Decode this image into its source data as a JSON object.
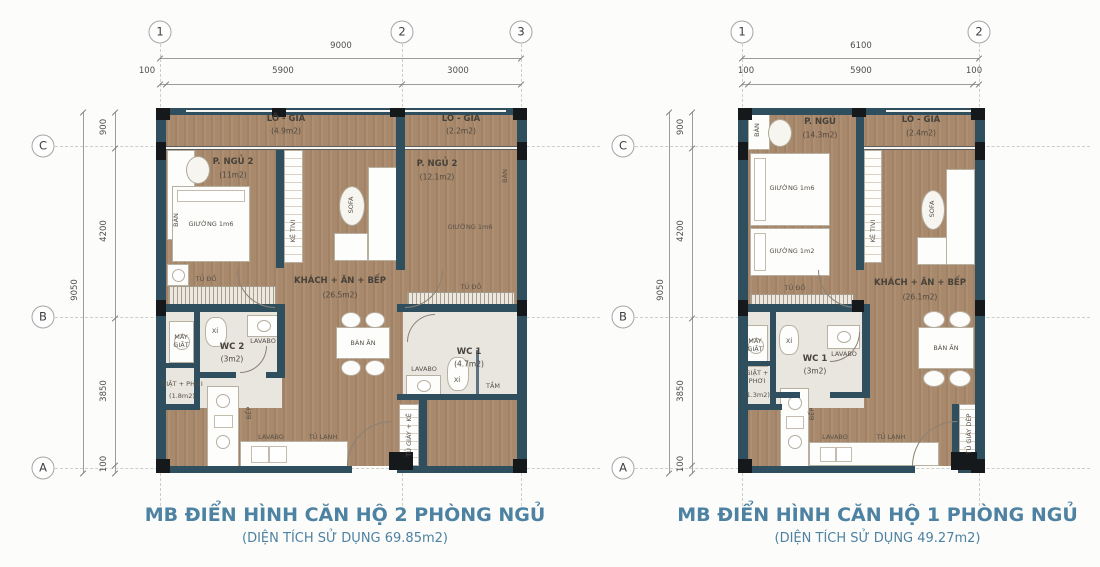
{
  "p2": {
    "title": "MB ĐIỂN HÌNH CĂN HỘ 2 PHÒNG NGỦ",
    "subtitle": "(DIỆN TÍCH SỬ DỤNG 69.85m2)",
    "cols": [
      "1",
      "2",
      "3"
    ],
    "rows": [
      "C",
      "B",
      "A"
    ],
    "dim_top_total": "9000",
    "dim_top": [
      "100",
      "5900",
      "3000"
    ],
    "dim_side_total": "9050",
    "dim_side": [
      "900",
      "4200",
      "3850",
      "100"
    ],
    "rooms": {
      "logia_l": {
        "n": "LÔ - GIA",
        "a": "(4.9m2)"
      },
      "logia_r": {
        "n": "LÔ - GIA",
        "a": "(2.2m2)"
      },
      "bed_l": {
        "n": "P. NGỦ 2",
        "a": "(11m2)"
      },
      "bed_r": {
        "n": "P. NGỦ 2",
        "a": "(12.1m2)"
      },
      "living": {
        "n": "KHÁCH + ĂN + BẾP",
        "a": "(26.5m2)"
      },
      "wc2": {
        "n": "WC 2",
        "a": "(3m2)"
      },
      "wc1": {
        "n": "WC 1",
        "a": "(4.7m2)"
      },
      "laundry": {
        "n": "GIẶT + PHƠI",
        "a": "(1.8m2)"
      }
    },
    "f": {
      "desk": "BÀN",
      "bed16": "GIƯỜNG 1m6",
      "wardrobe": "TỦ ĐỒ",
      "tv": "KỆ TIVI",
      "sofa": "SOFA",
      "dining": "BÀN ĂN",
      "washer": "MÁY GIẶT",
      "xi": "XÍ",
      "lavabo": "LAVABO",
      "bath": "TẮM",
      "stove": "BẾP",
      "fridge": "TỦ LẠNH",
      "shoe": "TỦ GIÀY + KỆ"
    }
  },
  "p1": {
    "title": "MB ĐIỂN HÌNH CĂN HỘ 1 PHÒNG NGỦ",
    "subtitle": "(DIỆN TÍCH SỬ DỤNG 49.27m2)",
    "cols": [
      "1",
      "2"
    ],
    "rows": [
      "C",
      "B",
      "A"
    ],
    "dim_top_total": "6100",
    "dim_top": [
      "100",
      "5900",
      "100"
    ],
    "dim_side_total": "9050",
    "dim_side": [
      "900",
      "4200",
      "3850",
      "100"
    ],
    "rooms": {
      "bedroom": {
        "n": "P. NGỦ",
        "a": "(14.3m2)"
      },
      "logia": {
        "n": "LÔ - GIA",
        "a": "(2.4m2)"
      },
      "living": {
        "n": "KHÁCH + ĂN + BẾP",
        "a": "(26.1m2)"
      },
      "wc": {
        "n": "WC 1",
        "a": "(3m2)"
      },
      "laundry": {
        "n": "GIẶT + PHƠI",
        "a": "(1.3m2)"
      }
    },
    "f": {
      "desk": "BÀN",
      "bed16": "GIƯỜNG 1m6",
      "bed12": "GIƯỜNG 1m2",
      "wardrobe": "TỦ ĐỒ",
      "tv": "KỆ TIVI",
      "sofa": "SOFA",
      "dining": "BÀN ĂN",
      "washer": "MÁY GIẶT",
      "xi": "XÍ",
      "lavabo": "LAVABO",
      "stove": "BẾP",
      "fridge": "TỦ LẠNH",
      "shoe": "TỦ GIÀY DÉP"
    }
  }
}
